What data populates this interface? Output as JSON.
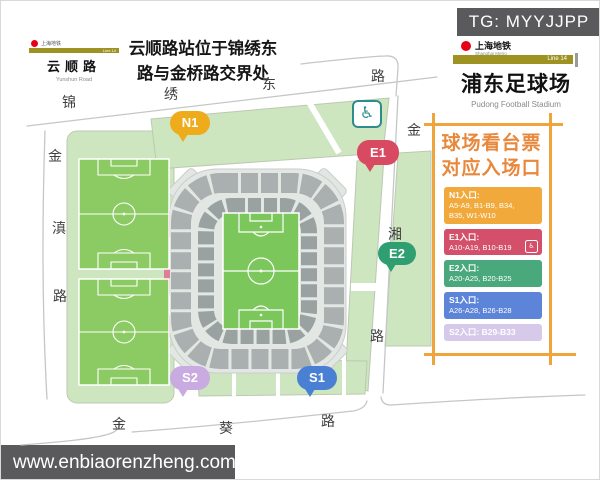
{
  "watermark_top": {
    "text": "TG: MYYJJPP"
  },
  "watermark_bottom": {
    "text": "www.enbiaorenzheng.com"
  },
  "left_station_sign": {
    "operator_zh": "上海地铁",
    "line_label": "Line 14",
    "station_zh": "云顺路",
    "station_en": "Yunshun Road"
  },
  "note": {
    "line1": "云顺路站位于锦绣东",
    "line2": "路与金桥路交界处"
  },
  "right_station_sign": {
    "operator_zh": "上海地铁",
    "operator_en": "Shanghai Metro",
    "line_label": "Line 14",
    "station_zh": "浦东足球场",
    "station_en": "Pudong Football Stadium"
  },
  "roads": {
    "north": [
      "锦",
      "绣",
      "东",
      "路"
    ],
    "west": [
      "金",
      "滇",
      "路"
    ],
    "south": [
      "金",
      "葵",
      "路"
    ],
    "east": [
      "金",
      "湘",
      "路"
    ]
  },
  "gate_bubbles": {
    "n1": "N1",
    "e1": "E1",
    "e2": "E2",
    "s1": "S1",
    "s2": "S2"
  },
  "accessibility": {
    "glyph": "♿"
  },
  "panel": {
    "title1": "球场看台票",
    "title2": "对应入场口",
    "entries": [
      {
        "gate": "N1入口:",
        "line1": "A5-A9, B1-B9, B34,",
        "line2": "B35, W1-W10"
      },
      {
        "gate": "E1入口:",
        "line1": "A10-A19, B10-B19"
      },
      {
        "gate": "E2入口:",
        "line1": "A20-A25, B20-B25"
      },
      {
        "gate": "S1入口:",
        "line1": "A26-A28, B26-B28"
      },
      {
        "gate": "S2入口: B29-B33"
      }
    ],
    "mini_icon_glyph": "♿"
  },
  "colors": {
    "gate_n1": "#EEAC1C",
    "gate_e1": "#D84A62",
    "gate_e2": "#2F9E70",
    "gate_s1": "#4A80D4",
    "gate_s2": "#C9ABE2",
    "panel_frame": "#F0A43C",
    "panel_title": "#E8883C",
    "line_band": "#9E9222",
    "metro_red": "#E60012",
    "pitch_green": "#7CC75C",
    "parcel_green": "#CDE6BF",
    "watermark_gray": "#5A5A5C"
  }
}
